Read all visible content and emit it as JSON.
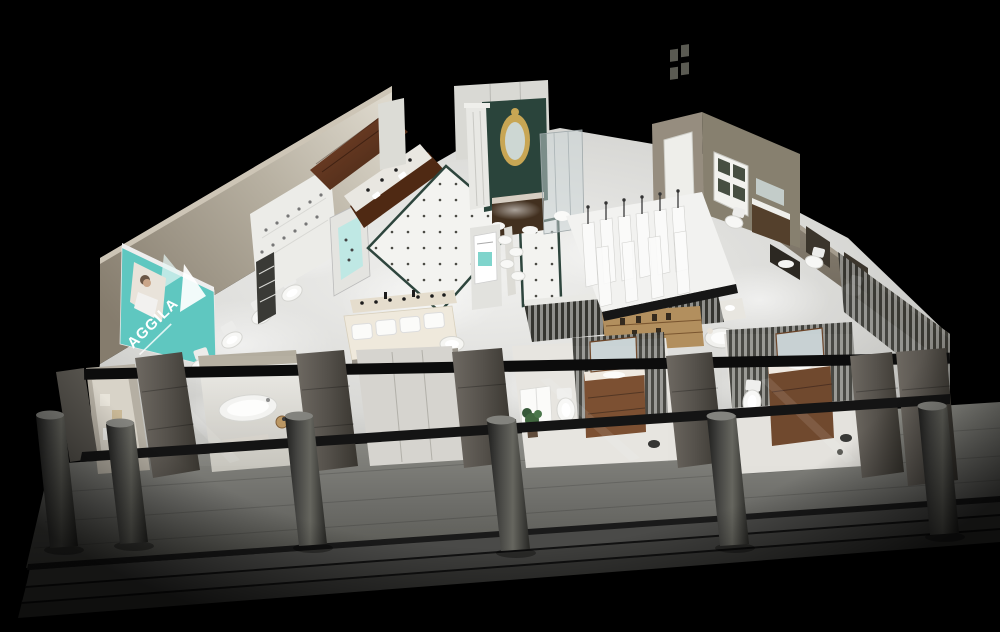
{
  "scene": {
    "description": "3D cutaway render of a bathroom fixtures showroom viewed from above at night",
    "background_color": "#000000"
  },
  "sign": {
    "brand": "AGGILA",
    "bg_color": "#5fc7c0",
    "text_color": "#ffffff"
  },
  "palette": {
    "floor_light": "#e9e9e6",
    "wall_cream": "#d9d4c8",
    "wall_tan": "#8a8172",
    "platform_gray": "#7c7c7a",
    "steps_gray": "#454545",
    "pier_gray": "#55514b",
    "wood_cabinet": "#6e3c20",
    "wood_vanity": "#7a4e31",
    "frame_black": "#111111",
    "trim_green": "#2e453d",
    "glass_blue": "#ccd5d7"
  }
}
